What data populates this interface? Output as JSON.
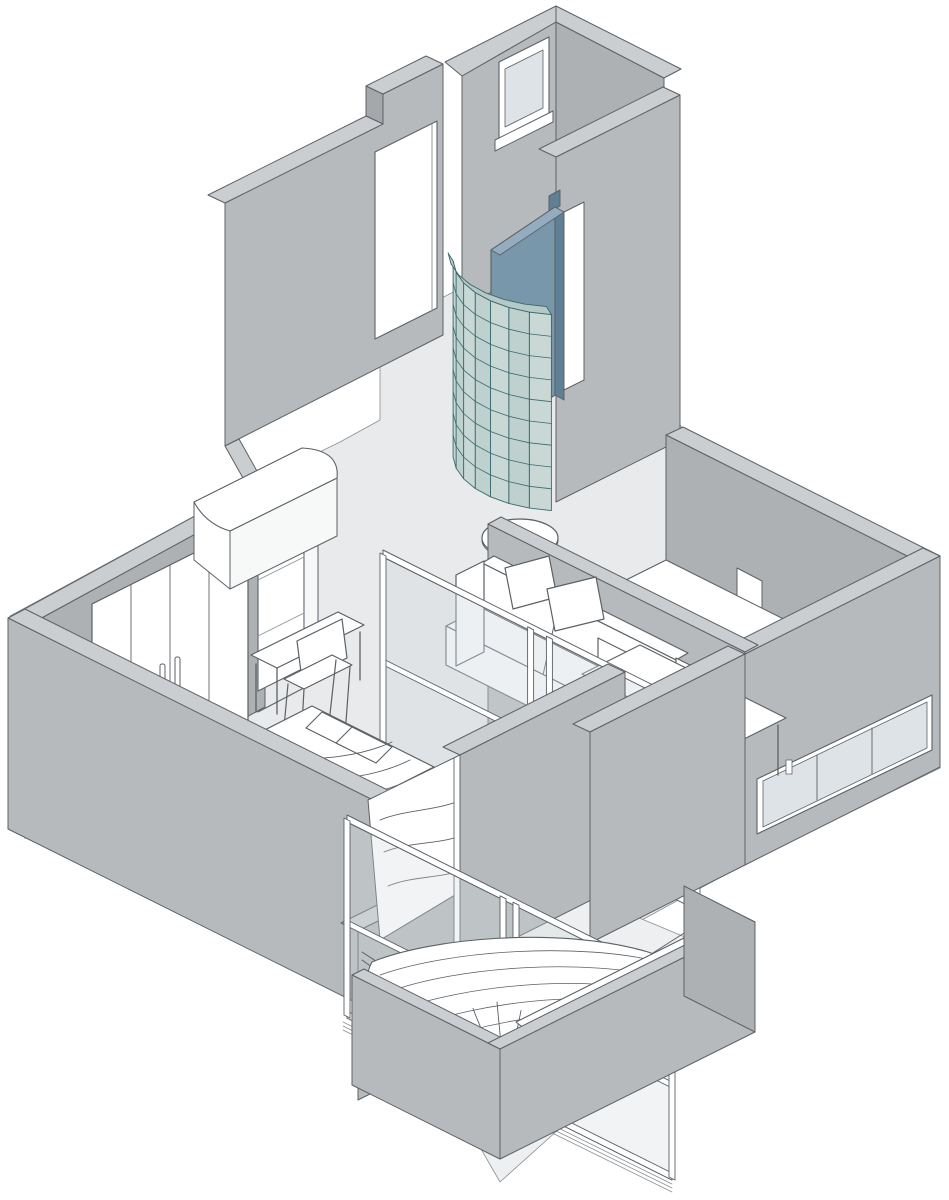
{
  "illustration": {
    "kind": "isometric-apartment-cutaway-axonometric",
    "projection": "2:1 isometric",
    "background": "#ffffff"
  },
  "palette": {
    "line": "#5c6166",
    "lineLight": "#8b9094",
    "wallFace": "#b7babc",
    "wallFace2": "#aeb1b3",
    "wallTop": "#cbced0",
    "wallStep": "#a5a8aa",
    "floor": "#e8eaeb",
    "floorBalcony": "#edeff0",
    "white": "#ffffff",
    "nearWhite": "#f7f8f8",
    "glassPane": "#dde3e6",
    "glassClear": "#cfd8dc",
    "gbFill": "#c9d8d5",
    "gbFillAlt": "#bfd1ce",
    "gbLine": "#3a6a6e",
    "gbRim": "#b7c9c7",
    "blueDoor": "#7897ab",
    "blueDoorSide": "#5f8094",
    "blueDoorTop": "#93acc0"
  },
  "params": {
    "glass_block_wall": {
      "cx": 565,
      "cy": 455,
      "rx": 112,
      "ry": 56,
      "deg_start": 97,
      "deg_end": 178,
      "height": 196,
      "columns": 7,
      "rows": 9
    },
    "glass_partition": {
      "x0": 383,
      "y0": 557,
      "x1": 697,
      "y1": 714,
      "height": 196,
      "stiles": [
        0,
        0.47,
        0.53,
        1
      ],
      "rail_frac": 0.52,
      "glass_opacity": 0.38
    },
    "balcony_doors": {
      "x0": 347,
      "y0": 822,
      "x1": 672,
      "y1": 984,
      "height": 196,
      "stiles": [
        0,
        0.48,
        0.52,
        1
      ],
      "rail_frac": 0.5,
      "tracks": 3,
      "glass_opacity": 0.3
    },
    "plant": {
      "x": 505,
      "y": 1102,
      "stems": 9,
      "spread": 64,
      "height": 100,
      "dots": 9
    }
  },
  "elements": [
    {
      "name": "vestibule",
      "desc": "full-height entry block with small high window"
    },
    {
      "name": "vestibule-window",
      "panes": 1
    },
    {
      "name": "entry-door-opening",
      "desc": "open doorway in corridor wall"
    },
    {
      "name": "glass-block-wall",
      "desc": "curved teal glass-block bathroom enclosure",
      "columns": 7,
      "rows": 9
    },
    {
      "name": "bathroom-door",
      "color_key": "blueDoor"
    },
    {
      "name": "kitchen-wing",
      "window_panes": 3,
      "counter": true,
      "tall-cabinet": true
    },
    {
      "name": "living-room",
      "sofa_cushions": 2,
      "sofa_pillows": 2,
      "coffee-table": true,
      "dining-table": true,
      "chairs": 2
    },
    {
      "name": "bedroom",
      "wardrobe_doors": 4,
      "wardrobe_handles": 2,
      "shelf": true,
      "desk": true,
      "chair": true,
      "bed": true
    },
    {
      "name": "glass-partition",
      "panels": 2
    },
    {
      "name": "balcony",
      "sliding_door_panels": 2,
      "hammock": true,
      "planter": true,
      "plant": true
    }
  ]
}
